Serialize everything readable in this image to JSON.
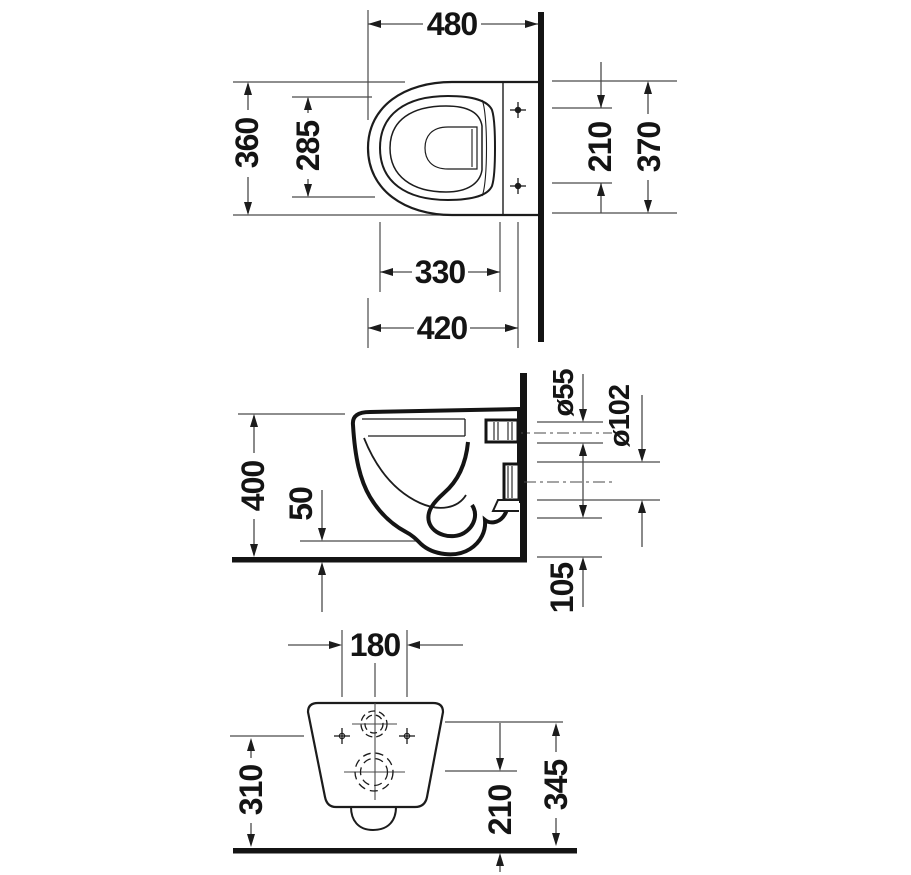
{
  "drawing": {
    "kind": "technical dimension drawing",
    "subject": "wall-hung toilet, three orthographic views",
    "units": "mm",
    "colors": {
      "line": "#1c1c1c",
      "thin_line": "#4a4a4a",
      "background": "#ffffff",
      "text": "#141414"
    },
    "views": {
      "plan": {
        "label": "top view",
        "dims": {
          "total_depth": "480",
          "overall_width": "360",
          "seat_inner_width": "285",
          "fixing_hole_spacing": "210",
          "rim_depth": "370",
          "rear_depth": "330",
          "mid_depth": "420"
        }
      },
      "elevation": {
        "label": "side view",
        "dims": {
          "rim_height": "400",
          "bottom_clearance": "50",
          "inlet_diameter": "ø55",
          "outlet_diameter": "ø102",
          "outlet_bottom_offset": "105"
        }
      },
      "rear": {
        "label": "rear view",
        "dims": {
          "fixing_hole_spacing": "180",
          "fixing_hole_height": "310",
          "outlet_center_height": "210",
          "inlet_center_height": "345"
        }
      }
    }
  }
}
